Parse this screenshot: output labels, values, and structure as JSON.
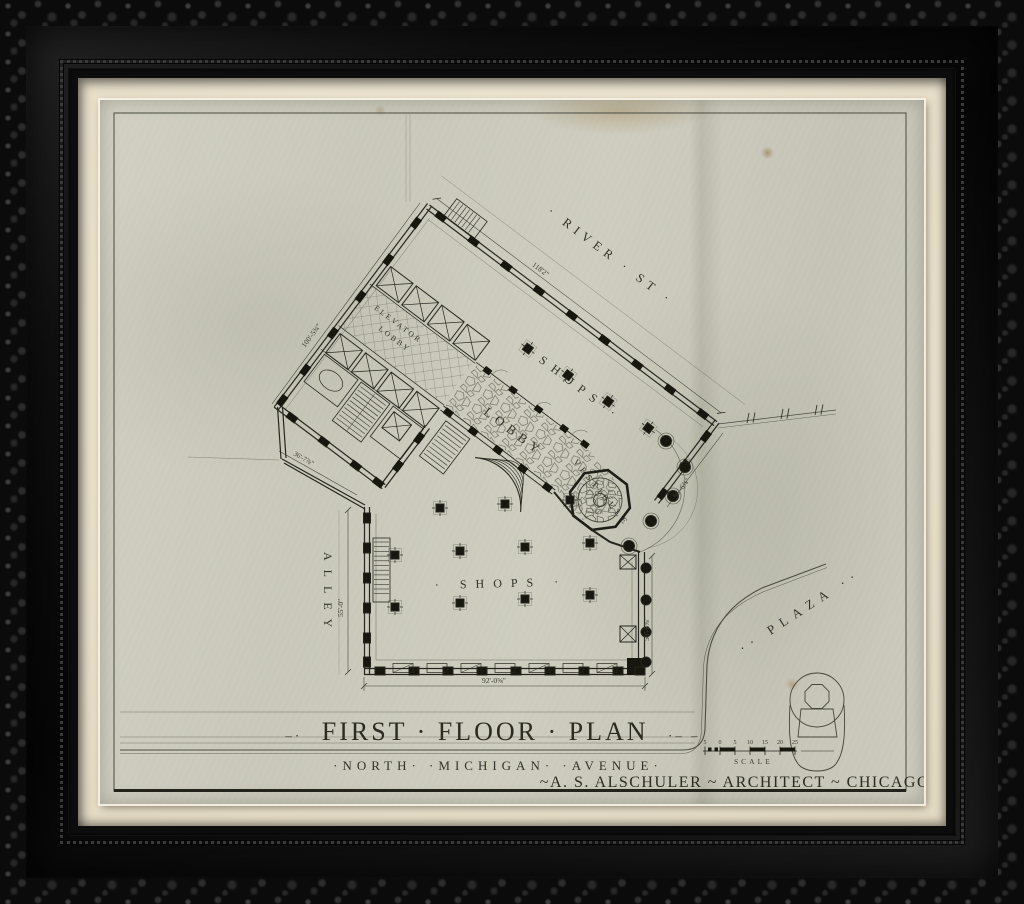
{
  "artwork": {
    "title": {
      "ornament_left": "–·",
      "text": "FIRST · FLOOR · PLAN",
      "ornament_right": "·– –"
    },
    "subtitle": "·NORTH·  ·MICHIGAN·  ·AVENUE·",
    "credit": "~A. S. ALSCHULER ~ ARCHITECT ~ CHICAGO~",
    "scale": {
      "label": "SCALE",
      "ticks": [
        "5",
        "0",
        "5",
        "10",
        "15",
        "20",
        "25"
      ]
    }
  },
  "plan_labels": {
    "street_top": "· RIVER · ST ·",
    "shops_wing": "· SHOPS ·",
    "elevator_lobby_line1": "ELEVATOR",
    "elevator_lobby_line2": "LOBBY",
    "lobby": "LOBBY",
    "vestibule": "VESTIBULE",
    "alley": "ALLEY",
    "shops_lower": "· SHOPS ·",
    "plaza": "·· PLAZA ··"
  },
  "dimensions": {
    "river_frontage": "118'2\"",
    "northwest_wall": "100'-5¾\"",
    "alley_diagonal": "36'-7⅞\"",
    "alley_side": "55'-0\"",
    "avenue_frontage": "92'-0⅝\"",
    "east_side": "50'-6⅝\"",
    "entrance_wall": "56'-6⅞\""
  },
  "colors": {
    "frame": "#0b0b0b",
    "mat": "#ece5d2",
    "paper": "#cbcabc",
    "ink": "#2e2e26"
  }
}
